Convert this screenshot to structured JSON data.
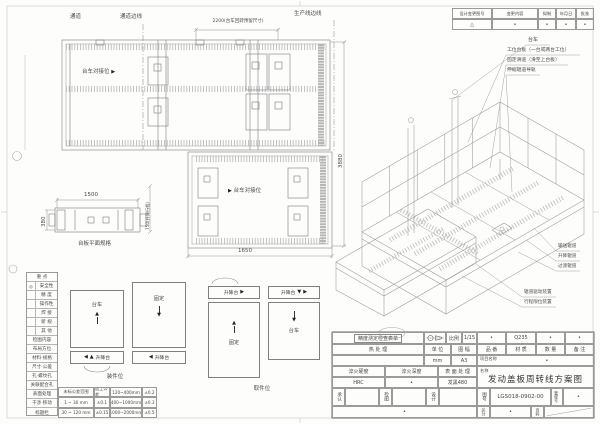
{
  "icons": {
    "up": "▲",
    "down": "▼",
    "left": "◀",
    "right": "▶",
    "triangle": "△",
    "dot": "•"
  },
  "plan_top": {
    "aisle": "通道",
    "aisle_edge": "通道边线",
    "dim_width": "2200(台车回转预留尺寸)",
    "prod_edge": "生产线边线",
    "dock_label": "台车对接位",
    "dim_height": "3880"
  },
  "plan_mid": {
    "dock_label": "台车对接位",
    "dim_width": "1650",
    "dim_lift": "750(升降行程)"
  },
  "plan_plate": {
    "dim_length": "1500",
    "dim_width": "380",
    "caption": "台板平面规格"
  },
  "checklist": {
    "header": "重  点",
    "items": [
      {
        "mark": "◎",
        "label": "安全性"
      },
      {
        "mark": "",
        "label": "精  度"
      },
      {
        "mark": "",
        "label": "操作性"
      },
      {
        "mark": "",
        "label": "焊  接"
      },
      {
        "mark": "",
        "label": "新  规"
      },
      {
        "mark": "",
        "label": "其  他"
      }
    ],
    "section2": "检图内容",
    "items2": [
      "布局方位",
      "材料·规格",
      "尺寸·公差",
      "孔·螺纹孔",
      "关联配合孔",
      "表面处理",
      "干涉·移动",
      "标题栏"
    ]
  },
  "tolerance": {
    "rows": [
      [
        "未标公差范围",
        "加工公差",
        "120~400mm",
        "±0.2"
      ],
      [
        "1 ~ 30 mm",
        "±0.1",
        "400~1000mm",
        "±0.3"
      ],
      [
        "30 ~ 120 mm",
        "±0.15",
        "1000~2000mm",
        "±0.5"
      ]
    ]
  },
  "schematics": {
    "trolley": "台车",
    "fixed": "固定",
    "lift": "升降台",
    "caption_load": "装件位",
    "caption_unload": "取件位"
  },
  "iso": {
    "callouts_top": [
      "台车",
      "工位台板（一台或两台工位）",
      "固定滑道（滑至上台板）",
      "伸缩辊道导轨"
    ],
    "callouts_mid": [
      "输送辊道",
      "升降辊道",
      "过渡辊道"
    ],
    "callouts_low": [
      "辊道驱动装置",
      "行程限位装置"
    ]
  },
  "revision": {
    "headers": [
      "设计变更图号",
      "变更内容",
      "拟制",
      "年月日",
      "批准"
    ],
    "row": [
      "△",
      "•",
      "•",
      "•",
      "•"
    ]
  },
  "title_block": {
    "inspection": "精度测定检查表单",
    "scale_label": "比例",
    "scale_value": "1/15",
    "part_headers": [
      "品 番",
      "材 质",
      "数 量",
      "备 注"
    ],
    "part_values": [
      "•",
      "Q235",
      "•",
      "•"
    ],
    "heat_label": "热  处  理",
    "unit_label": "单 位",
    "unit_value": "mm",
    "sheet_label": "图 幅",
    "sheet_value": "A3",
    "project_label": "项目名称",
    "project_value": "•",
    "quench_hardness_label": "淬火硬度",
    "quench_hardness_value": "HRC",
    "quench_depth_label": "淬火深度",
    "quench_depth_value": "•",
    "surface_label": "表 面 处 理",
    "surface_value": "发黑480",
    "name_label": "名称",
    "name_value": "发动盖板周转线方案图",
    "approve_label": "承认",
    "check_label": "检图",
    "design_label": "设计",
    "drawing_no_label": "图号",
    "drawing_no": "LGS018-0902-00",
    "mgmt_label": "管理号",
    "mgmt_value": "•",
    "class_label": "区分",
    "class_value": "•",
    "page_label": "页码",
    "footer_dot": "•"
  }
}
